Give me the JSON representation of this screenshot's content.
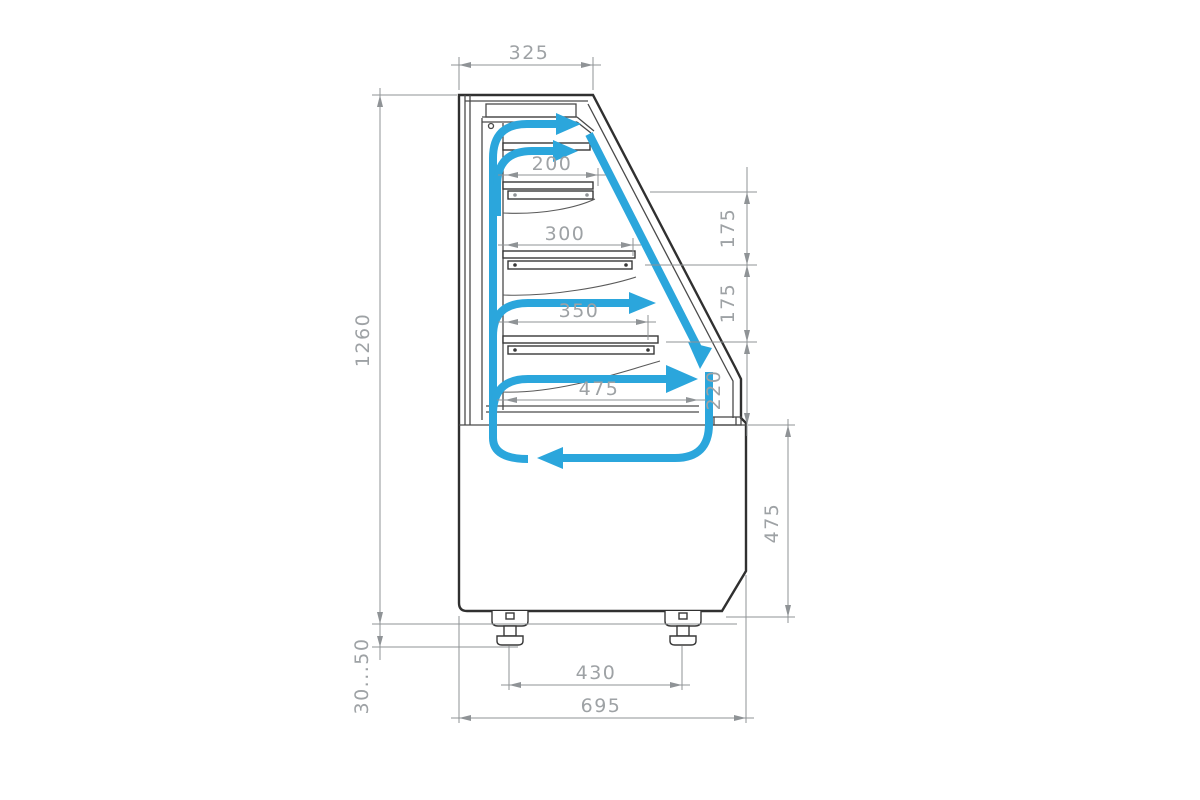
{
  "drawing": {
    "subject": "refrigerated-display-case-side-section",
    "view": "side-section-with-airflow"
  },
  "dims": {
    "top_depth": "325",
    "overall_height": "1260",
    "shelf1_depth": "200",
    "shelf2_depth": "300",
    "shelf3_depth": "350",
    "bottom_shelf_depth": "475",
    "gap_upper": "175",
    "gap_lower": "175",
    "front_glass_height": "220",
    "base_height": "475",
    "foot_adjust": "30...50",
    "foot_spacing": "430",
    "overall_depth": "695"
  },
  "colors": {
    "airflow": "#2BA6DC",
    "outline": "#303030",
    "dimension_lines": "#8f9396",
    "dimension_text": "#9EA2A5",
    "background": "#FFFFFF"
  }
}
